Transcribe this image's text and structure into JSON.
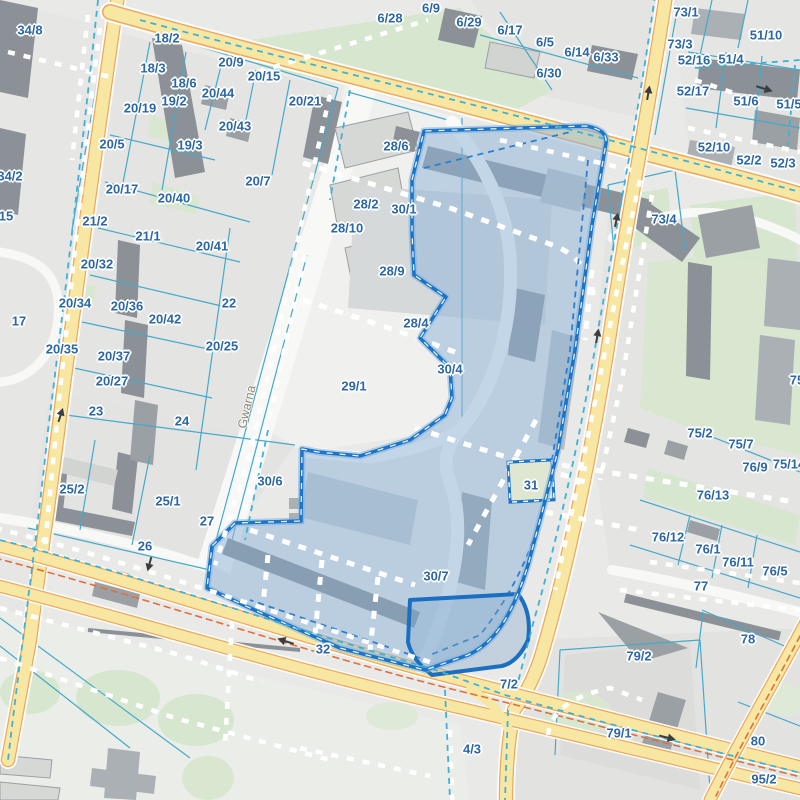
{
  "map": {
    "kind": "cadastral-parcel-map",
    "street_labels": [
      {
        "text": "Gwarna",
        "x": 247,
        "y": 407,
        "rotation": -77
      }
    ],
    "labels": [
      {
        "t": "34/8",
        "x": 30,
        "y": 30
      },
      {
        "t": "6/9",
        "x": 431,
        "y": 8
      },
      {
        "t": "6/28",
        "x": 390,
        "y": 18
      },
      {
        "t": "6/29",
        "x": 469,
        "y": 22
      },
      {
        "t": "6/17",
        "x": 510,
        "y": 30
      },
      {
        "t": "6/5",
        "x": 545,
        "y": 42
      },
      {
        "t": "6/14",
        "x": 577,
        "y": 52
      },
      {
        "t": "6/33",
        "x": 606,
        "y": 57
      },
      {
        "t": "6/30",
        "x": 549,
        "y": 73
      },
      {
        "t": "73/1",
        "x": 686,
        "y": 12
      },
      {
        "t": "51/10",
        "x": 766,
        "y": 35
      },
      {
        "t": "73/3",
        "x": 680,
        "y": 44
      },
      {
        "t": "52/16",
        "x": 694,
        "y": 60
      },
      {
        "t": "51/4",
        "x": 731,
        "y": 59
      },
      {
        "t": "52/17",
        "x": 693,
        "y": 91
      },
      {
        "t": "51/6",
        "x": 746,
        "y": 101
      },
      {
        "t": "51/5",
        "x": 789,
        "y": 104
      },
      {
        "t": "52/10",
        "x": 714,
        "y": 147
      },
      {
        "t": "52/2",
        "x": 749,
        "y": 160
      },
      {
        "t": "52/3",
        "x": 783,
        "y": 163
      },
      {
        "t": "18/2",
        "x": 167,
        "y": 38
      },
      {
        "t": "18/3",
        "x": 153,
        "y": 68
      },
      {
        "t": "20/9",
        "x": 231,
        "y": 62
      },
      {
        "t": "20/15",
        "x": 264,
        "y": 76
      },
      {
        "t": "18/6",
        "x": 184,
        "y": 83
      },
      {
        "t": "20/44",
        "x": 218,
        "y": 93
      },
      {
        "t": "19/2",
        "x": 174,
        "y": 101
      },
      {
        "t": "20/19",
        "x": 140,
        "y": 108
      },
      {
        "t": "20/21",
        "x": 305,
        "y": 101
      },
      {
        "t": "20/43",
        "x": 235,
        "y": 126
      },
      {
        "t": "19/3",
        "x": 190,
        "y": 145
      },
      {
        "t": "20/5",
        "x": 112,
        "y": 144
      },
      {
        "t": "20/7",
        "x": 258,
        "y": 181
      },
      {
        "t": "34/2",
        "x": 10,
        "y": 176
      },
      {
        "t": "20/17",
        "x": 122,
        "y": 189
      },
      {
        "t": "20/40",
        "x": 174,
        "y": 198
      },
      {
        "t": "15",
        "x": 6,
        "y": 216
      },
      {
        "t": "21/2",
        "x": 95,
        "y": 221
      },
      {
        "t": "21/1",
        "x": 148,
        "y": 236
      },
      {
        "t": "20/41",
        "x": 212,
        "y": 246
      },
      {
        "t": "20/32",
        "x": 97,
        "y": 264
      },
      {
        "t": "17",
        "x": 19,
        "y": 321
      },
      {
        "t": "20/34",
        "x": 75,
        "y": 303
      },
      {
        "t": "20/36",
        "x": 127,
        "y": 306
      },
      {
        "t": "22",
        "x": 229,
        "y": 303
      },
      {
        "t": "20/42",
        "x": 165,
        "y": 319
      },
      {
        "t": "20/35",
        "x": 62,
        "y": 349
      },
      {
        "t": "20/25",
        "x": 222,
        "y": 346
      },
      {
        "t": "20/37",
        "x": 114,
        "y": 356
      },
      {
        "t": "20/27",
        "x": 112,
        "y": 381
      },
      {
        "t": "23",
        "x": 96,
        "y": 411
      },
      {
        "t": "24",
        "x": 182,
        "y": 421
      },
      {
        "t": "25/2",
        "x": 72,
        "y": 489
      },
      {
        "t": "25/1",
        "x": 168,
        "y": 501
      },
      {
        "t": "26",
        "x": 145,
        "y": 546
      },
      {
        "t": "27",
        "x": 207,
        "y": 521
      },
      {
        "t": "28/6",
        "x": 396,
        "y": 146
      },
      {
        "t": "28/2",
        "x": 366,
        "y": 204
      },
      {
        "t": "30/1",
        "x": 404,
        "y": 209
      },
      {
        "t": "28/10",
        "x": 347,
        "y": 228
      },
      {
        "t": "28/9",
        "x": 392,
        "y": 271
      },
      {
        "t": "28/4",
        "x": 416,
        "y": 323
      },
      {
        "t": "29/1",
        "x": 354,
        "y": 386
      },
      {
        "t": "30/4",
        "x": 450,
        "y": 369
      },
      {
        "t": "30/6",
        "x": 270,
        "y": 481
      },
      {
        "t": "31",
        "x": 531,
        "y": 485
      },
      {
        "t": "30/7",
        "x": 436,
        "y": 576
      },
      {
        "t": "32",
        "x": 323,
        "y": 649
      },
      {
        "t": "7/2",
        "x": 509,
        "y": 684
      },
      {
        "t": "4/3",
        "x": 472,
        "y": 749
      },
      {
        "t": "79/2",
        "x": 639,
        "y": 656
      },
      {
        "t": "79/1",
        "x": 619,
        "y": 733
      },
      {
        "t": "80",
        "x": 758,
        "y": 741
      },
      {
        "t": "95/2",
        "x": 764,
        "y": 779
      },
      {
        "t": "73/4",
        "x": 664,
        "y": 219
      },
      {
        "t": "75",
        "x": 797,
        "y": 380
      },
      {
        "t": "75/2",
        "x": 700,
        "y": 433
      },
      {
        "t": "75/7",
        "x": 741,
        "y": 444
      },
      {
        "t": "76/9",
        "x": 755,
        "y": 467
      },
      {
        "t": "75/14",
        "x": 789,
        "y": 464
      },
      {
        "t": "76/13",
        "x": 713,
        "y": 495
      },
      {
        "t": "76/12",
        "x": 668,
        "y": 537
      },
      {
        "t": "76/1",
        "x": 708,
        "y": 549
      },
      {
        "t": "76/11",
        "x": 738,
        "y": 562
      },
      {
        "t": "76/5",
        "x": 775,
        "y": 571
      },
      {
        "t": "77",
        "x": 701,
        "y": 586
      },
      {
        "t": "78",
        "x": 748,
        "y": 639
      }
    ]
  },
  "colors": {
    "bg": "#e9eae8",
    "label": "#2c67a5",
    "street": "#8e897c",
    "road_yellow": "#f8e7a3",
    "road_orange": "#eda860",
    "parcel_line": "#45a9cb",
    "parcel_dash": "#3db2d8",
    "green": "#d7e6cf",
    "building_dark": "#8b9196",
    "building_mid": "#aab0b4",
    "selection_fill": "#8fb4d8",
    "selection_border": "#1b74c5",
    "tram_dash": "#e0703c"
  }
}
